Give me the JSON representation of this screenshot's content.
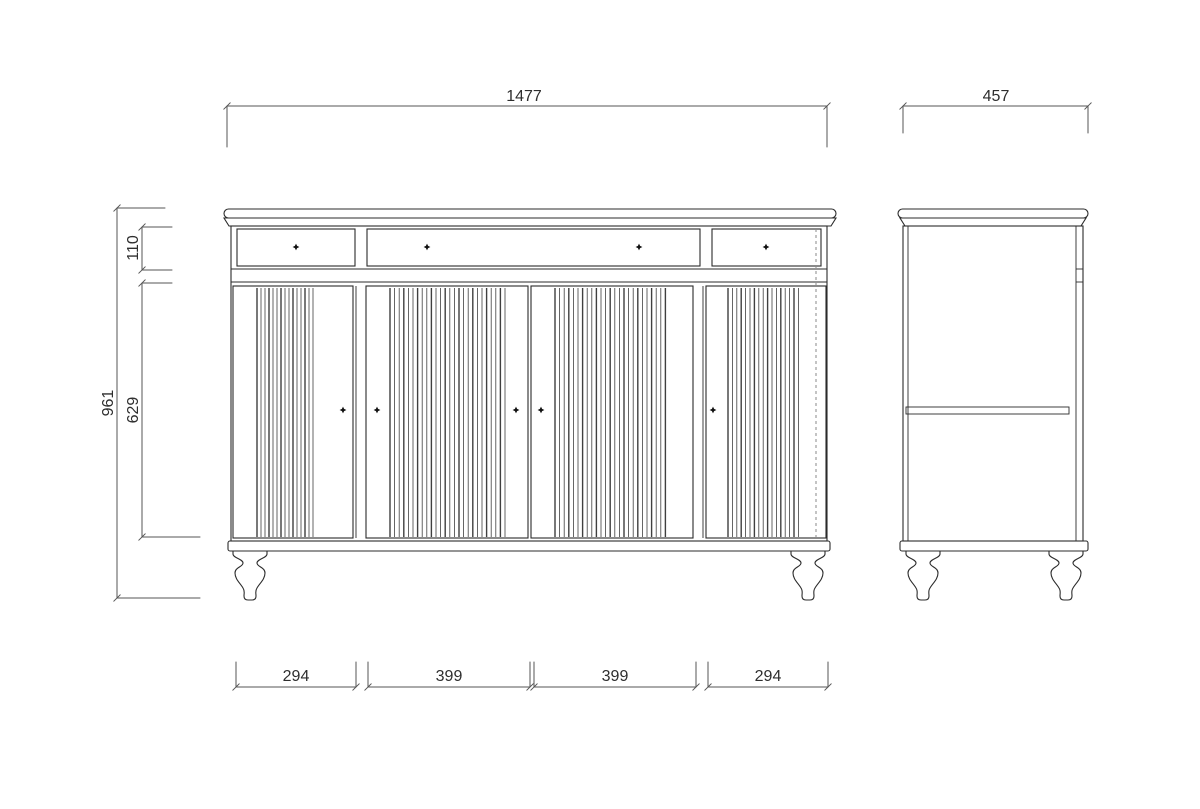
{
  "dimensions": {
    "front": {
      "overall_width": "1477",
      "overall_height": "961",
      "drawer_section_height": "110",
      "door_section_height": "629",
      "door_widths": [
        "294",
        "399",
        "399",
        "294"
      ]
    },
    "side": {
      "depth": "457"
    }
  },
  "colors": {
    "background": "#ffffff",
    "outline": "#2b2b2b",
    "dimension_line": "#555555",
    "dimension_text": "#2e2e2e",
    "hidden_line": "#8a8a8a"
  }
}
